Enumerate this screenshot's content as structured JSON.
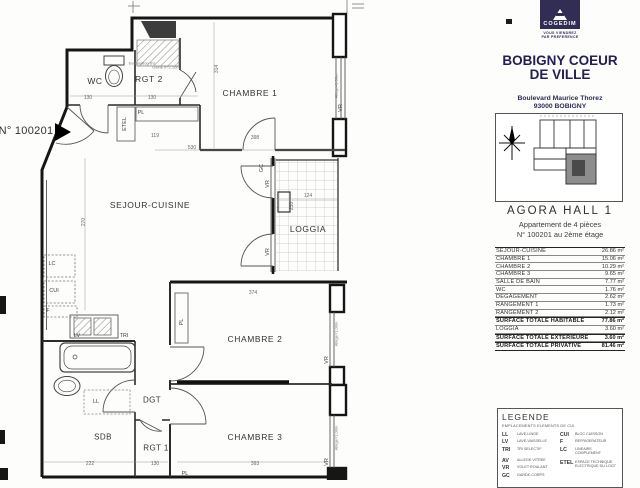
{
  "panel": {
    "logo": {
      "brand": "COGEDIM",
      "tagline_line1": "VOUS VIENDREZ",
      "tagline_line2": "PAR PREFERENCE"
    },
    "title_line1": "BOBIGNY COEUR",
    "title_line2": "DE VILLE",
    "address_line1": "Boulevard Maurice Thorez",
    "address_line2": "93000 BOBIGNY",
    "hall": "AGORA  HALL 1",
    "apt_type": "Appartement de 4 pièces",
    "apt_floor": "N° 100201 au 2ème étage",
    "colors": {
      "brand_navy": "#322d55",
      "title_navy": "#232050"
    },
    "surface_table": {
      "rows": [
        {
          "label": "SEJOUR-CUISINE",
          "value": "26.86 m²"
        },
        {
          "label": "CHAMBRE 1",
          "value": "15.06 m²"
        },
        {
          "label": "CHAMBRE 2",
          "value": "10.29 m²"
        },
        {
          "label": "CHAMBRE 3",
          "value": "9.65 m²"
        },
        {
          "label": "SALLE DE BAIN",
          "value": "7.77 m²"
        },
        {
          "label": "WC",
          "value": "1.76 m²"
        },
        {
          "label": "DEGAGEMENT",
          "value": "2.62 m²"
        },
        {
          "label": "RANGEMENT 1",
          "value": "1.73 m²"
        },
        {
          "label": "RANGEMENT 2",
          "value": "2.12 m²"
        },
        {
          "label": "SURFACE TOTALE HABITABLE",
          "value": "77.86 m²",
          "strong": true
        },
        {
          "label": "LOGGIA",
          "value": "3.60 m²"
        },
        {
          "label": "SURFACE TOTALE EXTERIEURE",
          "value": "3.60 m²",
          "strong": true
        },
        {
          "label": "SURFACE TOTALE PRIVATIVE",
          "value": "81.46 m²",
          "strong": true
        }
      ]
    },
    "legend": {
      "title": "LEGENDE",
      "subtitle": "EMPLACEMENTS ELEMENTS DE CUI.",
      "left": [
        {
          "abbr": "LL",
          "desc": "LAVE-LINGE"
        },
        {
          "abbr": "LV",
          "desc": "LAVE-VAISSELLE"
        },
        {
          "abbr": "TRI",
          "desc": "TRI SELECTIF"
        },
        {
          "abbr": "AV",
          "desc": "ALLEGE VITREE",
          "c": "gap"
        },
        {
          "abbr": "VR",
          "desc": "VOLET ROULANT"
        },
        {
          "abbr": "GC",
          "desc": "GARDE-CORPS"
        }
      ],
      "right": [
        {
          "abbr": "CUI",
          "desc": "BLOC CUISSON"
        },
        {
          "abbr": "F",
          "desc": "REFRIGERATEUR"
        },
        {
          "abbr": "LC",
          "desc": "LINEAIRE COMPLEMENT"
        },
        {
          "abbr": "ETEL",
          "desc": "ESPACE TECHNIQUE ELECTRIQUE DU LOGT",
          "c": "gap"
        }
      ]
    }
  },
  "plan": {
    "unit_marker": "N° 100201",
    "labels": [
      {
        "t": "WC",
        "x": 95,
        "y": 81,
        "c": "room"
      },
      {
        "t": "RGT 2",
        "x": 149,
        "y": 79,
        "c": "room"
      },
      {
        "t": "CHAMBRE 1",
        "x": 250,
        "y": 93,
        "c": "room"
      },
      {
        "t": "SEJOUR-CUISINE",
        "x": 150,
        "y": 205,
        "c": "room"
      },
      {
        "t": "LOGGIA",
        "x": 308,
        "y": 229,
        "c": "room"
      },
      {
        "t": "CHAMBRE 2",
        "x": 255,
        "y": 339,
        "c": "room"
      },
      {
        "t": "CHAMBRE 3",
        "x": 255,
        "y": 437,
        "c": "room"
      },
      {
        "t": "DGT",
        "x": 152,
        "y": 400,
        "c": "room-sm"
      },
      {
        "t": "SDB",
        "x": 103,
        "y": 437,
        "c": "room-sm"
      },
      {
        "t": "RGT 1",
        "x": 156,
        "y": 448,
        "c": "room-sm"
      },
      {
        "t": "130",
        "x": 88,
        "y": 98,
        "c": "dim"
      },
      {
        "t": "130",
        "x": 152,
        "y": 98,
        "c": "dim"
      },
      {
        "t": "119",
        "x": 155,
        "y": 136,
        "c": "dim"
      },
      {
        "t": "530",
        "x": 192,
        "y": 148,
        "c": "dim"
      },
      {
        "t": "398",
        "x": 255,
        "y": 138,
        "c": "dim"
      },
      {
        "t": "374",
        "x": 253,
        "y": 293,
        "c": "dim"
      },
      {
        "t": "124",
        "x": 308,
        "y": 196,
        "c": "dim"
      },
      {
        "t": "393",
        "x": 255,
        "y": 464,
        "c": "dim"
      },
      {
        "t": "222",
        "x": 90,
        "y": 464,
        "c": "dim"
      },
      {
        "t": "130",
        "x": 155,
        "y": 464,
        "c": "dim"
      },
      {
        "t": "314",
        "x": 217,
        "y": 69,
        "c": "dim",
        "r": 1
      },
      {
        "t": "270",
        "x": 84,
        "y": 222,
        "c": "dim",
        "r": 1
      },
      {
        "t": "230",
        "x": 292,
        "y": 206,
        "c": "dim",
        "r": 1
      },
      {
        "t": "ETEL",
        "x": 125,
        "y": 124,
        "c": "fix",
        "r": 1
      },
      {
        "t": "PL",
        "x": 141,
        "y": 113,
        "c": "fix"
      },
      {
        "t": "PL",
        "x": 182,
        "y": 322,
        "c": "fix",
        "r": 1
      },
      {
        "t": "PL",
        "x": 185,
        "y": 474,
        "c": "fix"
      },
      {
        "t": "GC",
        "x": 262,
        "y": 168,
        "c": "fix",
        "r": 1
      },
      {
        "t": "LC",
        "x": 52,
        "y": 264,
        "c": "fix"
      },
      {
        "t": "CUI",
        "x": 54,
        "y": 291,
        "c": "fix"
      },
      {
        "t": "F",
        "x": 48,
        "y": 311,
        "c": "fix"
      },
      {
        "t": "LV",
        "x": 77,
        "y": 336,
        "c": "fix"
      },
      {
        "t": "TRI",
        "x": 124,
        "y": 336,
        "c": "fix"
      },
      {
        "t": "LL",
        "x": 96,
        "y": 402,
        "c": "fix"
      },
      {
        "t": "VR",
        "x": 341,
        "y": 108,
        "c": "fix",
        "r": 1
      },
      {
        "t": "VR",
        "x": 268,
        "y": 184,
        "c": "fix",
        "r": 1
      },
      {
        "t": "VR",
        "x": 268,
        "y": 252,
        "c": "fix",
        "r": 1
      },
      {
        "t": "VR",
        "x": 327,
        "y": 360,
        "c": "fix",
        "r": 1
      },
      {
        "t": "VR",
        "x": 327,
        "y": 462,
        "c": "fix",
        "r": 1
      },
      {
        "t": "Allège=1.00m",
        "x": 336,
        "y": 86,
        "c": "tiny",
        "r": 1
      },
      {
        "t": "Allège=1.00m",
        "x": 336,
        "y": 334,
        "c": "tiny",
        "r": 1
      },
      {
        "t": "Allège=1.00m",
        "x": 336,
        "y": 438,
        "c": "tiny",
        "r": 1
      },
      {
        "t": "Evacuation SV",
        "x": 142,
        "y": 63,
        "c": "tiny"
      },
      {
        "t": "Gaine h=2.20m",
        "x": 166,
        "y": 67,
        "c": "tiny"
      }
    ]
  }
}
